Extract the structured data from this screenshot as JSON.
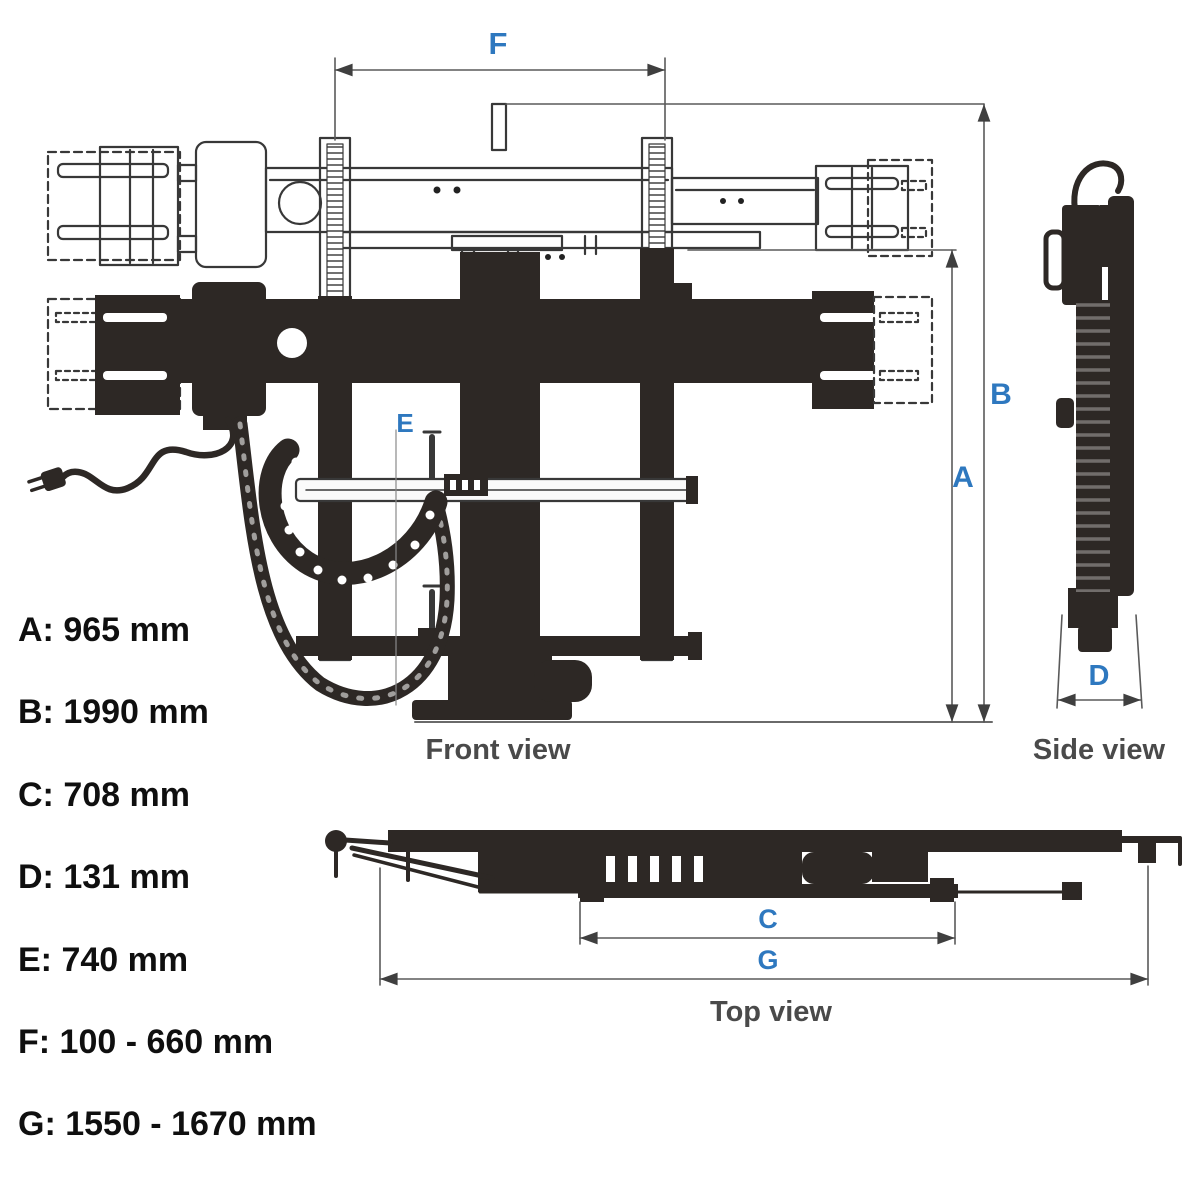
{
  "views": {
    "front": {
      "label": "Front view"
    },
    "side": {
      "label": "Side view"
    },
    "top": {
      "label": "Top view"
    }
  },
  "dim_letters": {
    "A": "A",
    "B": "B",
    "C": "C",
    "D": "D",
    "E": "E",
    "F": "F",
    "G": "G"
  },
  "measurements": [
    {
      "letter": "A",
      "text": "A: 965 mm"
    },
    {
      "letter": "B",
      "text": "B: 1990 mm"
    },
    {
      "letter": "C",
      "text": "C: 708 mm"
    },
    {
      "letter": "D",
      "text": "D: 131 mm"
    },
    {
      "letter": "E",
      "text": "E: 740 mm"
    },
    {
      "letter": "F",
      "text": "F: 100 - 660 mm"
    },
    {
      "letter": "G",
      "text": "G: 1550 - 1670 mm"
    }
  ],
  "colors": {
    "dimension_blue": "#2e78bf",
    "view_label_gray": "#4a4a4a",
    "drawing_ink": "#333333",
    "solid_fill": "#2d2825",
    "dimension_line_gray": "#5a5a5a"
  }
}
